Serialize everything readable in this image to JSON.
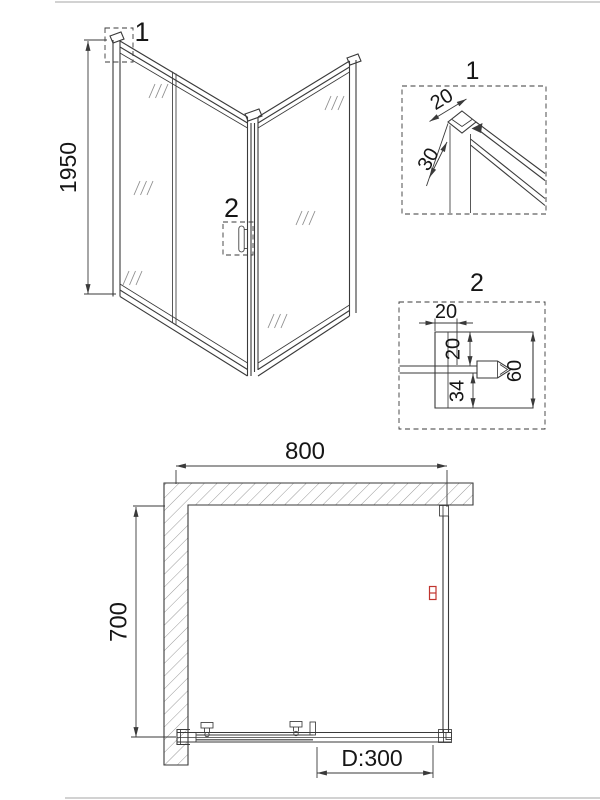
{
  "views": {
    "perspective": {
      "detail1_marker": "1",
      "detail2_marker": "2",
      "height_dim": "1950"
    },
    "detail1": {
      "label": "1",
      "profile_width_dim": "20",
      "profile_depth_dim": "30"
    },
    "detail2": {
      "label": "2",
      "profile_width_dim": "20",
      "top_gap_dim": "20",
      "bottom_gap_dim": "34",
      "total_height_dim": "60"
    },
    "plan": {
      "width_dim": "800",
      "depth_dim": "700",
      "door_opening_dim": "D:300"
    }
  },
  "colors": {
    "line": "#3a3a3a",
    "hatch": "#9a9a9a",
    "handle_red": "#c0342e",
    "page_border": "#cccccc",
    "text": "#161616"
  }
}
